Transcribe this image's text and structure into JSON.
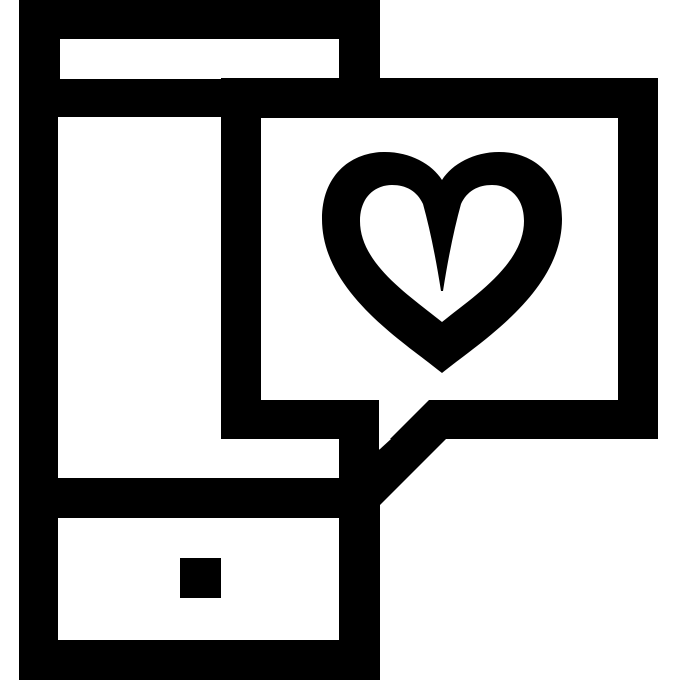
{
  "icon": {
    "title": "Smartphone with heart message speech bubble",
    "type": "pictogram",
    "elements": {
      "phone": "smartphone outline with speaker slot and square home button",
      "bubble": "rectangular speech bubble overlapping phone, tail pointing down-left to phone edge",
      "heart": "outlined heart with deep central notch inside the bubble"
    },
    "colors": {
      "foreground": "#000000",
      "background": "#ffffff"
    }
  }
}
